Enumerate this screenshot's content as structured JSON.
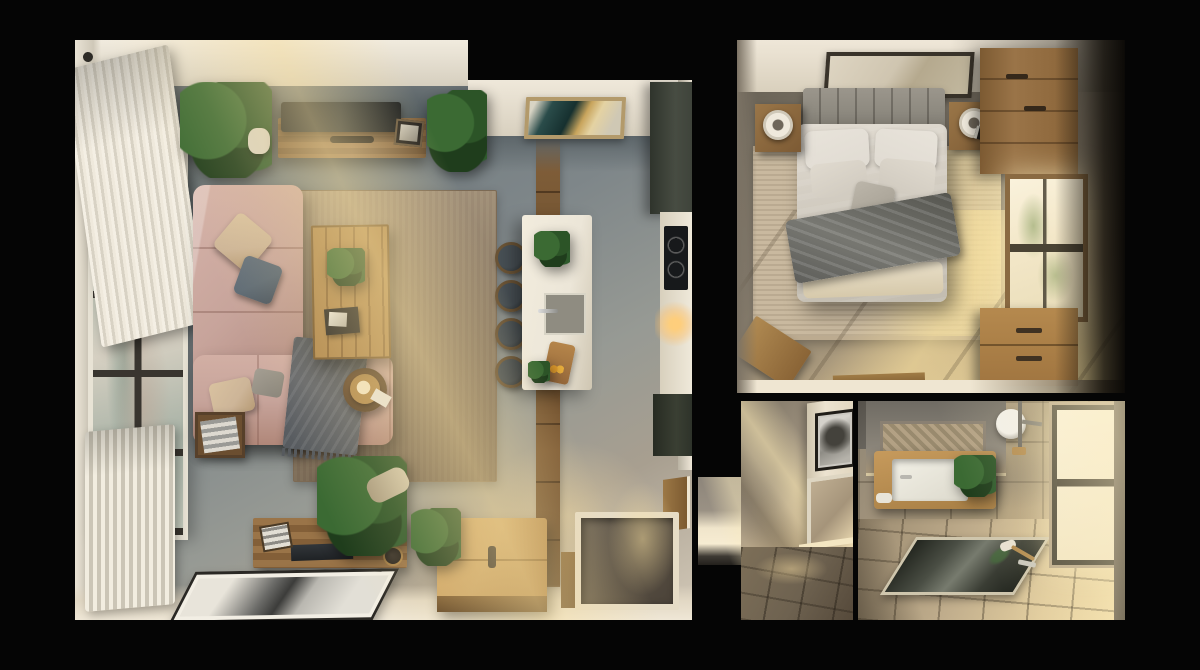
{
  "meta": {
    "kind": "photorealistic top-down 3D floor-plan render of a small apartment",
    "background": "#050505",
    "text_visible": false
  },
  "palette": {
    "bg": "#050505",
    "wall_cream": "#eee7d9",
    "wall_cream_dim": "#d5cdbc",
    "concrete_dark": "#4e585c",
    "concrete": "#7e8689",
    "concrete_warm": "#a89f90",
    "floor_sun": "#ecd7a6",
    "wood": "#9a7448",
    "wood_dark": "#6a4e2e",
    "wood_light": "#c9a265",
    "sofa": "#c7a49b",
    "sofa_dark": "#a87f74",
    "pillow_beige": "#cdb598",
    "pillow_blue": "#5d6a75",
    "throw_gray": "#63666b",
    "rug_jute": "#8f7c63",
    "island_white": "#ece6d8",
    "stool_dark": "#2f3437",
    "olive": "#3f443b",
    "cooktop": "#17191b",
    "glow": "#f2c97e",
    "duvet": "#d0cabf",
    "pillow_white": "#e0dbd2",
    "headboard": "#8e8a80",
    "bedroom_rug": "#c9b99f",
    "bedroom_floor": "#857c6e",
    "bedroom_sun": "#eeda9f",
    "stone": "#a89878",
    "stone_gray": "#8b857a",
    "window_glow": "#f8efd8",
    "glass_green": "#ccd4c6",
    "frame_dark": "#343028",
    "brass": "#b28a4e",
    "art_teal": "#2a4c4a",
    "art_gold": "#c8a45c",
    "leaf1": "#3b6a33",
    "leaf2": "#2c5427",
    "leaf3": "#1f3d1c"
  },
  "rooms": [
    {
      "name": "living-room-kitchen",
      "items": [
        "window-wall",
        "curtain",
        "radiator",
        "corner-sofa",
        "throw-pillows",
        "gray-throw",
        "jute-rug",
        "coffee-table",
        "tv-console",
        "wall-tv",
        "abstract-artwork",
        "kitchen-island",
        "sink",
        "bar-stools",
        "cutting-board",
        "kitchen-counter",
        "cooktop",
        "upper-cabinets",
        "lower-cabinets",
        "wood-beam-inlay",
        "storage-chest",
        "sideboard",
        "laptop",
        "floor-artwork",
        "entry-nook",
        "door",
        "potted-plants",
        "gold-lamp",
        "side-table",
        "magazine-box",
        "sunbeam"
      ]
    },
    {
      "name": "bedroom",
      "items": [
        "double-bed",
        "tufted-headboard",
        "pillows",
        "dark-throw",
        "area-rug",
        "nightstand-left",
        "nightstand-right",
        "ring-lamps",
        "book",
        "wall-artwork",
        "wardrobe",
        "window",
        "dresser",
        "wood-bench",
        "wood-tray",
        "sunbeams"
      ]
    },
    {
      "name": "hallway",
      "items": [
        "stone-wall",
        "framed-photo",
        "leaning-mirror",
        "tiled-floor",
        "sunbeam"
      ]
    },
    {
      "name": "bathroom",
      "items": [
        "stone-tile-walls",
        "woven-panel",
        "bathtub",
        "basin",
        "plant",
        "shower-head",
        "pipes",
        "brass-valve",
        "window",
        "sunken-floor-mirror",
        "floor-fixtures",
        "towel-roll",
        "sunbeam"
      ]
    }
  ]
}
